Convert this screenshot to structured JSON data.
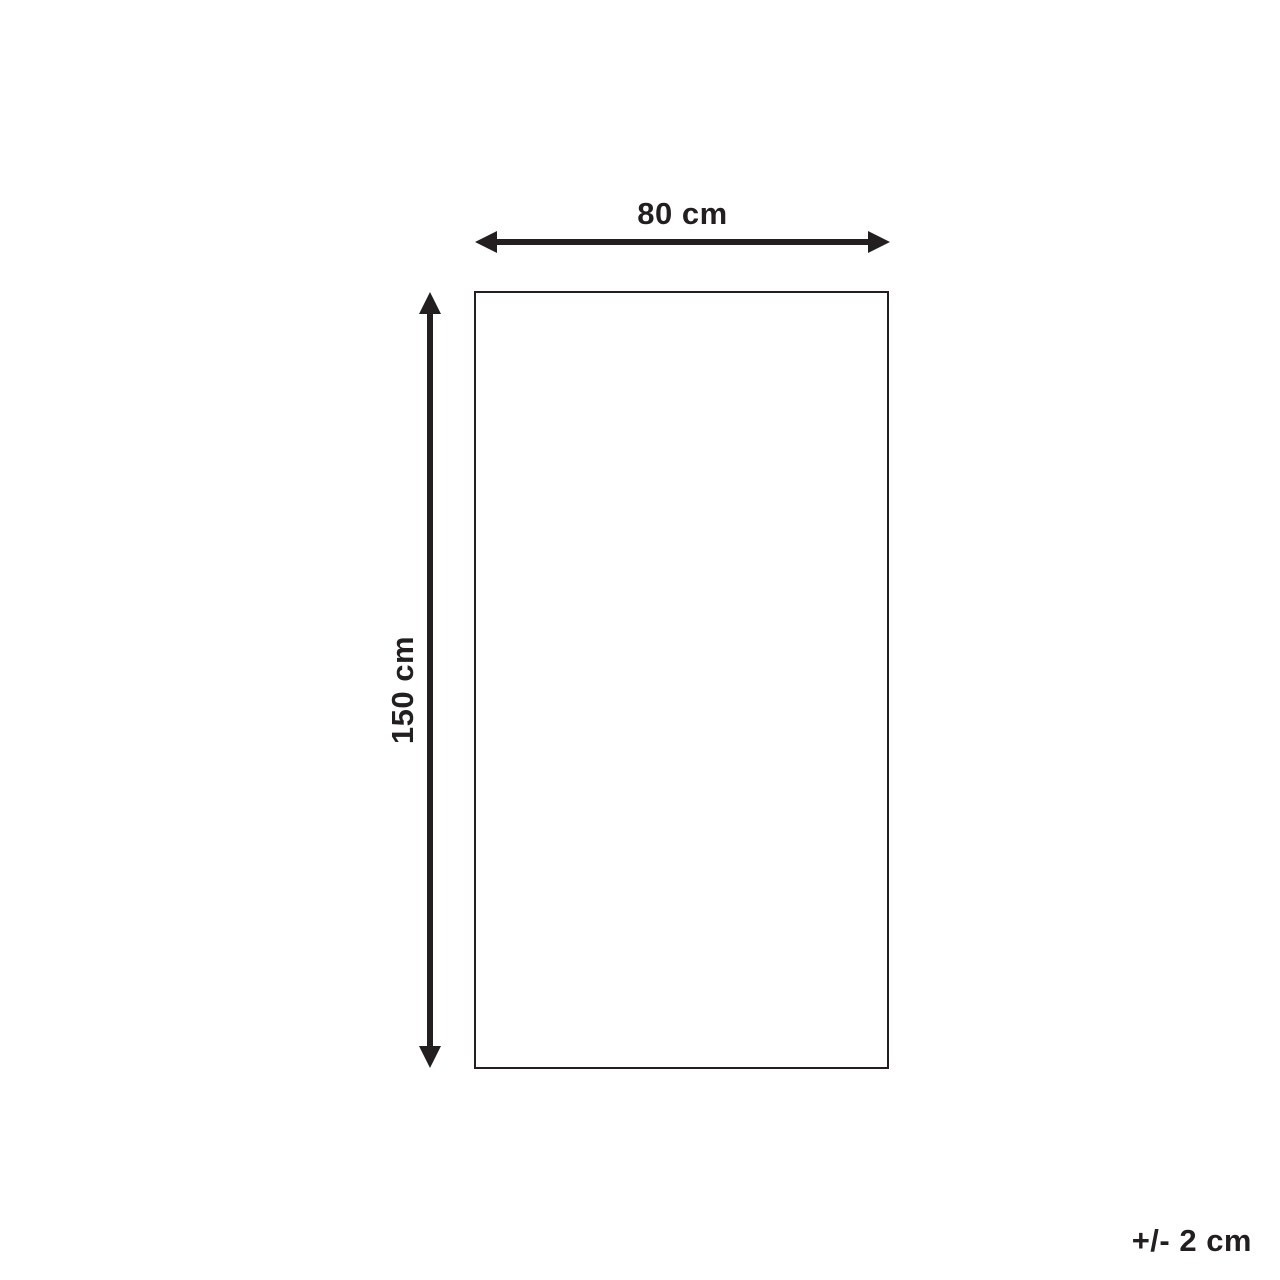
{
  "diagram": {
    "width_label": "80 cm",
    "height_label": "150 cm",
    "tolerance_label": "+/- 2 cm",
    "colors": {
      "ink": "#231f20",
      "background": "#ffffff"
    }
  }
}
